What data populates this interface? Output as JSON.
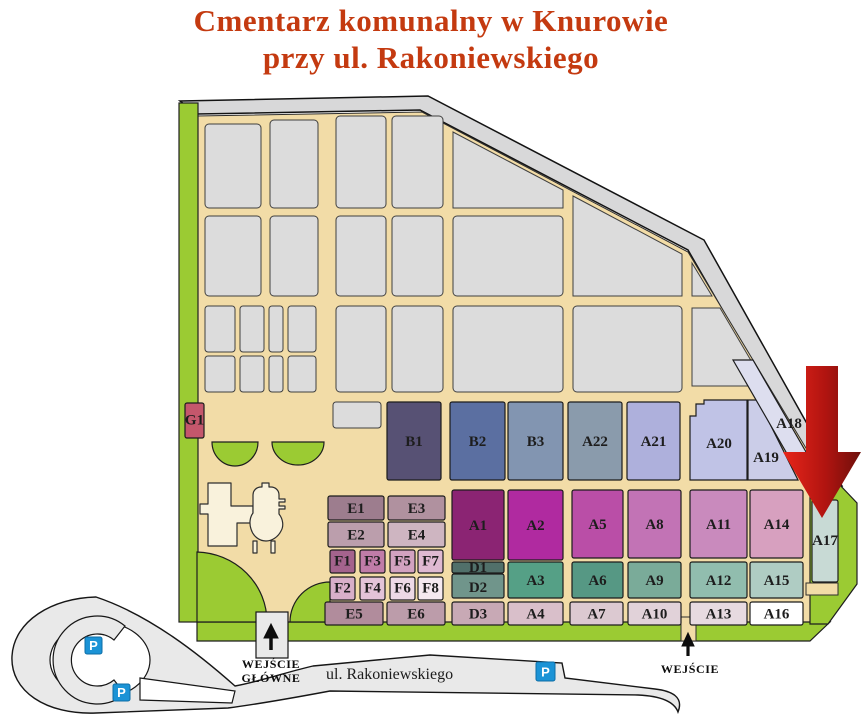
{
  "title": {
    "line1": "Cmentarz komunalny w Knurowie",
    "line2": "przy ul. Rakoniewskiego",
    "color": "#C43A10"
  },
  "map": {
    "street_label": "ul. Rakoniewskiego",
    "main_entrance": {
      "line1": "WEJŚCIE",
      "line2": "GŁÓWNE"
    },
    "side_entrance": {
      "label": "WEJŚCIE"
    },
    "parking": [
      "P",
      "P",
      "P"
    ],
    "arrow": {
      "color_start": "#E8251A",
      "color_end": "#6E0F0B"
    },
    "palette": {
      "lawn_green": "#9BCB33",
      "path_tan": "#F2DCA7",
      "border_gray": "#D8D8D9",
      "plot_gray": "#DCDCDC",
      "road_gray": "#E9E9E9",
      "parking_blue": "#1B93D6",
      "building_cream": "#F9F2DC"
    },
    "sections": [
      {
        "id": "G1",
        "label": "G1",
        "x": 185,
        "y": 403,
        "w": 19,
        "h": 35,
        "color": "#C4576C",
        "fs": 11
      },
      {
        "id": "B1",
        "label": "B1",
        "x": 387,
        "y": 402,
        "w": 54,
        "h": 78,
        "color": "#575174"
      },
      {
        "id": "B2",
        "label": "B2",
        "x": 450,
        "y": 402,
        "w": 55,
        "h": 78,
        "color": "#5B6FA1"
      },
      {
        "id": "B3",
        "label": "B3",
        "x": 508,
        "y": 402,
        "w": 55,
        "h": 78,
        "color": "#8295B1"
      },
      {
        "id": "A22",
        "label": "A22",
        "x": 568,
        "y": 402,
        "w": 54,
        "h": 78,
        "color": "#8A9BAC"
      },
      {
        "id": "A21",
        "label": "A21",
        "x": 627,
        "y": 402,
        "w": 53,
        "h": 78,
        "color": "#AEB0DC"
      },
      {
        "id": "A20",
        "label": "A20",
        "pts": "690,416 696,416 696,404 704,404 704,400 747,400 747,480 690,480",
        "color": "#C0C3E6",
        "lx": 719,
        "ly": 443
      },
      {
        "id": "A19",
        "label": "A19",
        "pts": "748,400 758,400 798,480 748,480",
        "color": "#CBCDE8",
        "lx": 766,
        "ly": 457
      },
      {
        "id": "A18",
        "label": "A18",
        "pts": "733,360 753,360 821,478 801,478",
        "color": "#DDDEEF",
        "lx": 789,
        "ly": 423
      },
      {
        "id": "E1",
        "label": "E1",
        "x": 328,
        "y": 496,
        "w": 56,
        "h": 24,
        "color": "#9D7D8E",
        "fs": 14
      },
      {
        "id": "E3",
        "label": "E3",
        "x": 388,
        "y": 496,
        "w": 57,
        "h": 24,
        "color": "#B0919F",
        "fs": 14
      },
      {
        "id": "E2",
        "label": "E2",
        "x": 328,
        "y": 522,
        "w": 56,
        "h": 25,
        "color": "#BB9EAC",
        "fs": 14
      },
      {
        "id": "E4",
        "label": "E4",
        "x": 388,
        "y": 522,
        "w": 57,
        "h": 25,
        "color": "#CEB5C1",
        "fs": 14
      },
      {
        "id": "F1",
        "label": "F1",
        "x": 330,
        "y": 550,
        "w": 25,
        "h": 23,
        "color": "#A4638D",
        "fs": 13
      },
      {
        "id": "F3",
        "label": "F3",
        "x": 360,
        "y": 550,
        "w": 25,
        "h": 23,
        "color": "#C07CA8",
        "fs": 13
      },
      {
        "id": "F5",
        "label": "F5",
        "x": 390,
        "y": 550,
        "w": 25,
        "h": 23,
        "color": "#D2A2C0",
        "fs": 13
      },
      {
        "id": "F7",
        "label": "F7",
        "x": 418,
        "y": 550,
        "w": 25,
        "h": 23,
        "color": "#DFB9D2",
        "fs": 13
      },
      {
        "id": "F2",
        "label": "F2",
        "x": 330,
        "y": 577,
        "w": 25,
        "h": 23,
        "color": "#D8AFC9",
        "fs": 13
      },
      {
        "id": "F4",
        "label": "F4",
        "x": 360,
        "y": 577,
        "w": 25,
        "h": 23,
        "color": "#E3C3D8",
        "fs": 13
      },
      {
        "id": "F6",
        "label": "F6",
        "x": 390,
        "y": 577,
        "w": 25,
        "h": 23,
        "color": "#EDD9E6",
        "fs": 13
      },
      {
        "id": "F8",
        "label": "F8",
        "x": 418,
        "y": 577,
        "w": 25,
        "h": 23,
        "color": "#F5E9F0",
        "fs": 13
      },
      {
        "id": "A1",
        "label": "A1",
        "x": 452,
        "y": 490,
        "w": 52,
        "h": 70,
        "color": "#8B2473"
      },
      {
        "id": "D1",
        "label": "D1",
        "x": 452,
        "y": 562,
        "w": 52,
        "h": 11,
        "color": "#51706A",
        "fs": 12,
        "ly": 568
      },
      {
        "id": "D2",
        "label": "D2",
        "x": 452,
        "y": 574,
        "w": 52,
        "h": 24,
        "color": "#70958B",
        "fs": 14,
        "ly": 587
      },
      {
        "id": "A2",
        "label": "A2",
        "x": 508,
        "y": 490,
        "w": 55,
        "h": 70,
        "color": "#B02AA0"
      },
      {
        "id": "A3",
        "label": "A3",
        "x": 508,
        "y": 562,
        "w": 55,
        "h": 36,
        "color": "#55A086",
        "fs": 14
      },
      {
        "id": "A5",
        "label": "A5",
        "x": 572,
        "y": 490,
        "w": 51,
        "h": 68,
        "color": "#BA4EA7"
      },
      {
        "id": "A8",
        "label": "A8",
        "x": 628,
        "y": 490,
        "w": 53,
        "h": 68,
        "color": "#C273B5"
      },
      {
        "id": "A11",
        "label": "A11",
        "x": 690,
        "y": 490,
        "w": 57,
        "h": 68,
        "color": "#C98ABD"
      },
      {
        "id": "A14",
        "label": "A14",
        "x": 750,
        "y": 490,
        "w": 53,
        "h": 68,
        "color": "#D7A0BF"
      },
      {
        "id": "A6",
        "label": "A6",
        "x": 572,
        "y": 562,
        "w": 51,
        "h": 36,
        "color": "#569884",
        "fs": 14
      },
      {
        "id": "A9",
        "label": "A9",
        "x": 628,
        "y": 562,
        "w": 53,
        "h": 36,
        "color": "#7AAB99",
        "fs": 14
      },
      {
        "id": "A12",
        "label": "A12",
        "x": 690,
        "y": 562,
        "w": 57,
        "h": 36,
        "color": "#91BDAE",
        "fs": 14
      },
      {
        "id": "A15",
        "label": "A15",
        "x": 750,
        "y": 562,
        "w": 53,
        "h": 36,
        "color": "#AFCCC3",
        "fs": 14
      },
      {
        "id": "E5",
        "label": "E5",
        "x": 325,
        "y": 602,
        "w": 58,
        "h": 23,
        "color": "#B18C9C",
        "fs": 14
      },
      {
        "id": "E6",
        "label": "E6",
        "x": 387,
        "y": 602,
        "w": 58,
        "h": 23,
        "color": "#BC9CAA",
        "fs": 14
      },
      {
        "id": "D3",
        "label": "D3",
        "x": 452,
        "y": 602,
        "w": 52,
        "h": 23,
        "color": "#C8A9B5",
        "fs": 14
      },
      {
        "id": "A4",
        "label": "A4",
        "x": 508,
        "y": 602,
        "w": 55,
        "h": 23,
        "color": "#D9BFCA",
        "fs": 14
      },
      {
        "id": "A7",
        "label": "A7",
        "x": 570,
        "y": 602,
        "w": 53,
        "h": 23,
        "color": "#DCC9D1",
        "fs": 14
      },
      {
        "id": "A10",
        "label": "A10",
        "x": 628,
        "y": 602,
        "w": 53,
        "h": 23,
        "color": "#E1D2D9",
        "fs": 14
      },
      {
        "id": "A13",
        "label": "A13",
        "x": 690,
        "y": 602,
        "w": 57,
        "h": 23,
        "color": "#E7DAE0",
        "fs": 14
      },
      {
        "id": "A16",
        "label": "A16",
        "x": 750,
        "y": 602,
        "w": 53,
        "h": 23,
        "color": "#FFFFFF",
        "fs": 14
      },
      {
        "id": "A17",
        "label": "A17",
        "x": 812,
        "y": 500,
        "w": 26,
        "h": 82,
        "color": "#C8DAD5",
        "fs": 14,
        "ly": 540
      }
    ]
  }
}
